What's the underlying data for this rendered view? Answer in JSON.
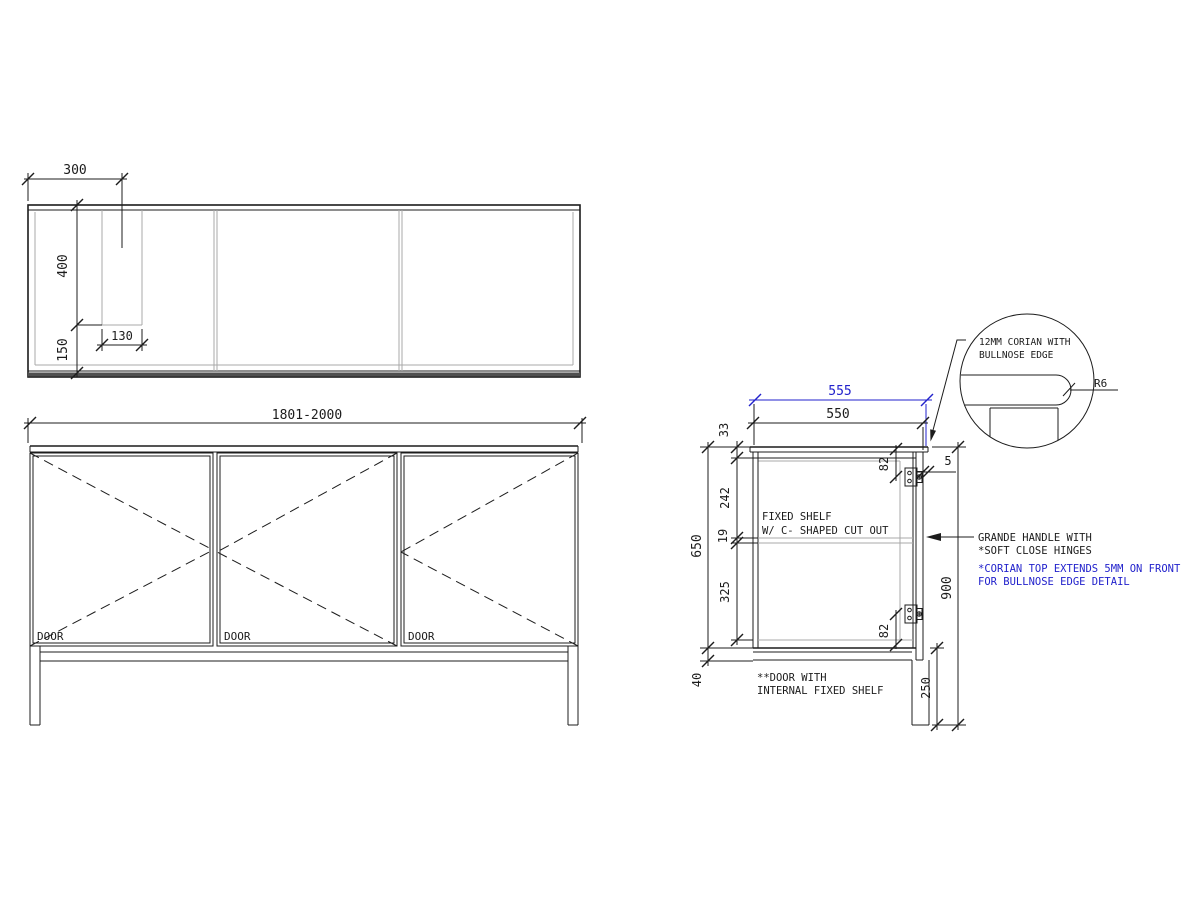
{
  "plan_view": {
    "dim_offset_left": "300",
    "dim_depth_to_cutout": "400",
    "dim_cutout_width": "130",
    "dim_depth_lower": "150"
  },
  "front_view": {
    "dim_width_range": "1801-2000",
    "doors": [
      "DOOR",
      "DOOR",
      "DOOR"
    ]
  },
  "section_view": {
    "dim_top_depth_corian": "555",
    "dim_top_depth_carcass": "550",
    "dim_top_thickness": "33",
    "dim_space_above_shelf": "242",
    "dim_shelf_thickness": "19",
    "dim_space_below_shelf": "325",
    "dim_carcass_height": "650",
    "dim_below_carcass": "40",
    "dim_overall_height": "900",
    "dim_leg_height": "250",
    "dim_hinge_top_offset": "82",
    "dim_hinge_bottom_offset": "82",
    "dim_front_overhang": "5",
    "label_shelf_line1": "FIXED SHELF",
    "label_shelf_line2": "W/ C- SHAPED CUT OUT",
    "label_handle_line1": "GRANDE HANDLE WITH",
    "label_handle_line2": "*SOFT CLOSE HINGES",
    "note_corian_line1": "*CORIAN TOP EXTENDS 5MM ON FRONT",
    "note_corian_line2": "FOR BULLNOSE EDGE DETAIL",
    "note_door_line1": "**DOOR WITH",
    "note_door_line2": "INTERNAL FIXED SHELF"
  },
  "detail_view": {
    "label_line1": "12MM CORIAN WITH",
    "label_line2": "BULLNOSE EDGE",
    "dim_bullnose_radius": "R6"
  },
  "colors": {
    "line": "#1c1c1c",
    "light_line": "#a8a8a8",
    "accent_blue": "#2222cc",
    "background": "#ffffff"
  }
}
